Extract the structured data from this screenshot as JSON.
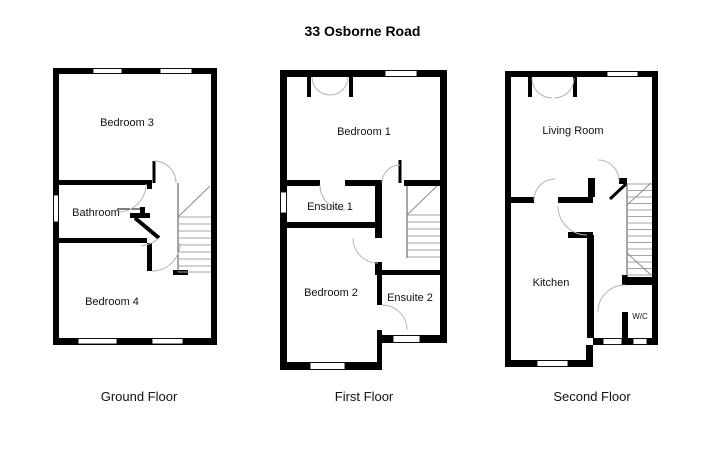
{
  "title": "33 Osborne Road",
  "floors": {
    "ground": {
      "label": "Ground Floor",
      "rooms": {
        "bedroom3": "Bedroom 3",
        "bathroom": "Bathroom",
        "bedroom4": "Bedroom 4"
      }
    },
    "first": {
      "label": "First Floor",
      "rooms": {
        "bedroom1": "Bedroom 1",
        "ensuite1": "Ensuite 1",
        "bedroom2": "Bedroom 2",
        "ensuite2": "Ensuite 2"
      }
    },
    "second": {
      "label": "Second Floor",
      "rooms": {
        "living_room": "Living Room",
        "kitchen": "Kitchen",
        "wc": "W/C"
      }
    }
  },
  "colors": {
    "wall": "#000000",
    "background": "#ffffff",
    "door_arc": "#b3b3b3",
    "stair_tread": "#a6a6a6"
  }
}
